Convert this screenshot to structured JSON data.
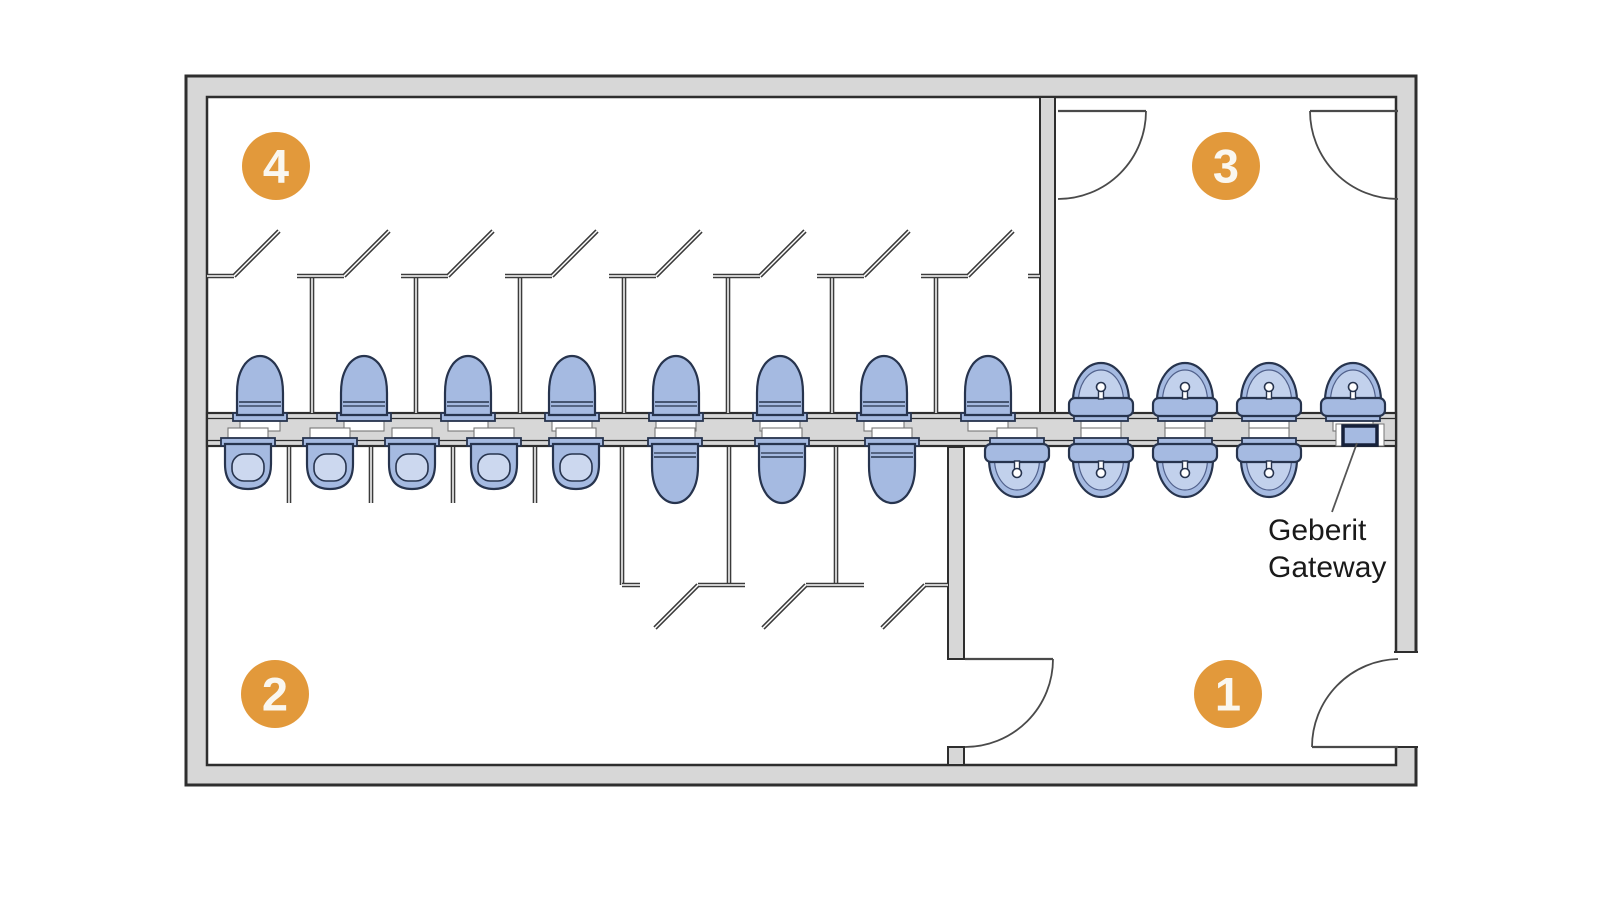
{
  "colors": {
    "background": "#ffffff",
    "wall_fill": "#d7d7d7",
    "wall_stroke": "#2e2e2e",
    "partition": "#3b3b3b",
    "door_line": "#4a4a4a",
    "fixture_fill": "#a5bae1",
    "fixture_stroke": "#27344e",
    "fixture_inner": "#ccd8ef",
    "basin_inner": "#c2d1ec",
    "flush_fill": "#ffffff",
    "flush_stroke": "#777777",
    "badge_fill": "#e2993b",
    "badge_text": "#faf7f0",
    "label_text": "#1a1a1a",
    "leader": "#555555",
    "gateway_stroke": "#16213a"
  },
  "plan": {
    "outer": {
      "x": 186,
      "y": 76,
      "w": 1230,
      "h": 709
    },
    "inner": {
      "x": 207,
      "y": 97,
      "w": 1189,
      "h": 668
    },
    "central_wall": {
      "x": 207,
      "y": 413,
      "w": 1189,
      "h": 33
    },
    "divider_top": {
      "x": 1040,
      "y": 97,
      "w": 15,
      "h": 316
    },
    "divider_bottom": {
      "x": 948,
      "y": 447,
      "w": 16,
      "h": 212
    },
    "divider_bottom_stub": {
      "x": 948,
      "y": 747,
      "w": 16,
      "h": 18
    },
    "right_wall_gap": {
      "x": 1394,
      "y": 652,
      "w": 24,
      "h": 95
    },
    "doors": [
      {
        "leaf": [
          1058,
          111,
          1146,
          111
        ],
        "arc": "M 1146 111 A 88 88 0 0 1 1058 199"
      },
      {
        "leaf": [
          1310,
          111,
          1398,
          111
        ],
        "arc": "M 1310 111 A 88 88 0 0 0 1398 199"
      },
      {
        "leaf": [
          965,
          659,
          1053,
          659
        ],
        "arc": "M 1053 659 A 88 88 0 0 1 965 747"
      },
      {
        "leaf": [
          1312,
          747,
          1398,
          747
        ],
        "arc": "M 1312 747 A 88 88 0 0 1 1398 659"
      }
    ],
    "stalls_top": {
      "front_y": 276,
      "leaf_top_y": 231,
      "partition_bottom_y": 413,
      "partitions_x": [
        312,
        416,
        520,
        624,
        728,
        832,
        936
      ],
      "stubs": [
        [
          207,
          234
        ],
        [
          297,
          344
        ],
        [
          401,
          448
        ],
        [
          505,
          552
        ],
        [
          609,
          656
        ],
        [
          713,
          760
        ],
        [
          817,
          864
        ],
        [
          921,
          968
        ],
        [
          1028,
          1040
        ]
      ],
      "leaves_from_x": [
        234,
        344,
        448,
        552,
        656,
        760,
        864,
        968
      ]
    },
    "stalls_bottom": {
      "front_y": 585,
      "leaf_bottom_y": 628,
      "partition_top_y": 447,
      "partitions_x": [
        622,
        729,
        836
      ],
      "stubs": [
        [
          622,
          640
        ],
        [
          698,
          745
        ],
        [
          806,
          864
        ],
        [
          925,
          948
        ]
      ],
      "leaves_from_x": [
        698,
        806,
        925
      ]
    },
    "urinal_screens": {
      "xs": [
        289,
        371,
        453,
        535
      ],
      "y1": 447,
      "y2": 503
    }
  },
  "fixtures": {
    "toilets_top": [
      260,
      364,
      468,
      572,
      676,
      780,
      884,
      988
    ],
    "toilets_bottom": [
      675,
      782,
      892
    ],
    "urinals": [
      248,
      330,
      412,
      494,
      576
    ],
    "basins_top": [
      1101,
      1185,
      1269,
      1353
    ],
    "basins_bottom": [
      1017,
      1101,
      1185,
      1269
    ],
    "gateway": {
      "x": 1343,
      "y": 426,
      "w": 34,
      "h": 19,
      "notch": [
        1336,
        424,
        48,
        22
      ]
    }
  },
  "badges": [
    {
      "label": "4",
      "cx": 276,
      "cy": 166
    },
    {
      "label": "3",
      "cx": 1226,
      "cy": 166
    },
    {
      "label": "2",
      "cx": 275,
      "cy": 694
    },
    {
      "label": "1",
      "cx": 1228,
      "cy": 694
    }
  ],
  "annotation": {
    "lines": [
      "Geberit",
      "Gateway"
    ],
    "x": 1268,
    "line1_y": 540,
    "line2_y": 577,
    "font_size": 30,
    "leader": [
      1357,
      443,
      1332,
      512
    ]
  }
}
